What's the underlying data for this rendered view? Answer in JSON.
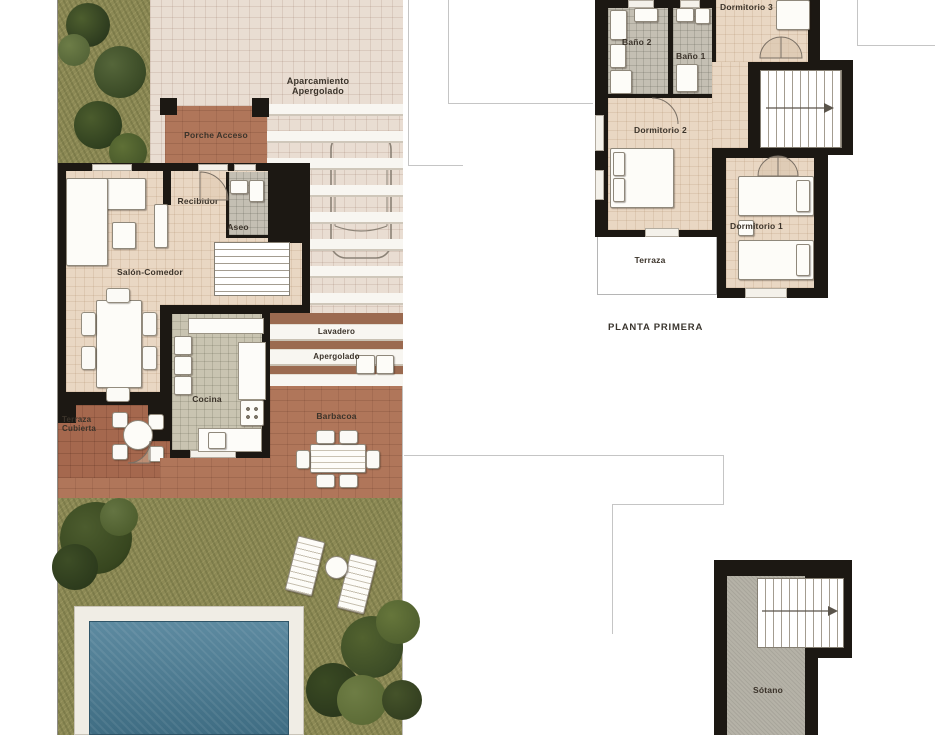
{
  "plan_type": "architectural-floor-plan",
  "ground_floor": {
    "rooms": {
      "aparcamiento": "Aparcamiento\nApergolado",
      "porche": "Porche Acceso",
      "recibidor": "Recibidor",
      "aseo": "Aseo",
      "salon": "Salón-Comedor",
      "cocina": "Cocina",
      "lavadero": "Lavadero",
      "apergolado": "Apergolado",
      "barbacoa": "Barbacoa",
      "terraza_cubierta": "Terraza\nCubierta"
    }
  },
  "first_floor": {
    "title": "PLANTA PRIMERA",
    "rooms": {
      "dormitorio3": "Dormitorio 3",
      "bano2": "Baño 2",
      "bano1": "Baño 1",
      "dormitorio2": "Dormitorio 2",
      "dormitorio1": "Dormitorio 1",
      "terraza": "Terraza"
    }
  },
  "basement": {
    "rooms": {
      "sotano": "Sótano"
    }
  },
  "colors": {
    "wall": "#1c1813",
    "floor_cream": "#e9d7c3",
    "floor_tile_gray": "#c4bfb3",
    "kitchen_tile": "#c9c4b1",
    "terracotta": "#b0765a",
    "terracotta_dark": "#a5684e",
    "parking_tile": "#e9ddd2",
    "pergola_beam": "#f8f6f1",
    "lawn": "#8c8955",
    "pool_water": "#4e7e94",
    "pool_deck": "#f0ede5",
    "basement_floor": "#b5b2a7"
  }
}
